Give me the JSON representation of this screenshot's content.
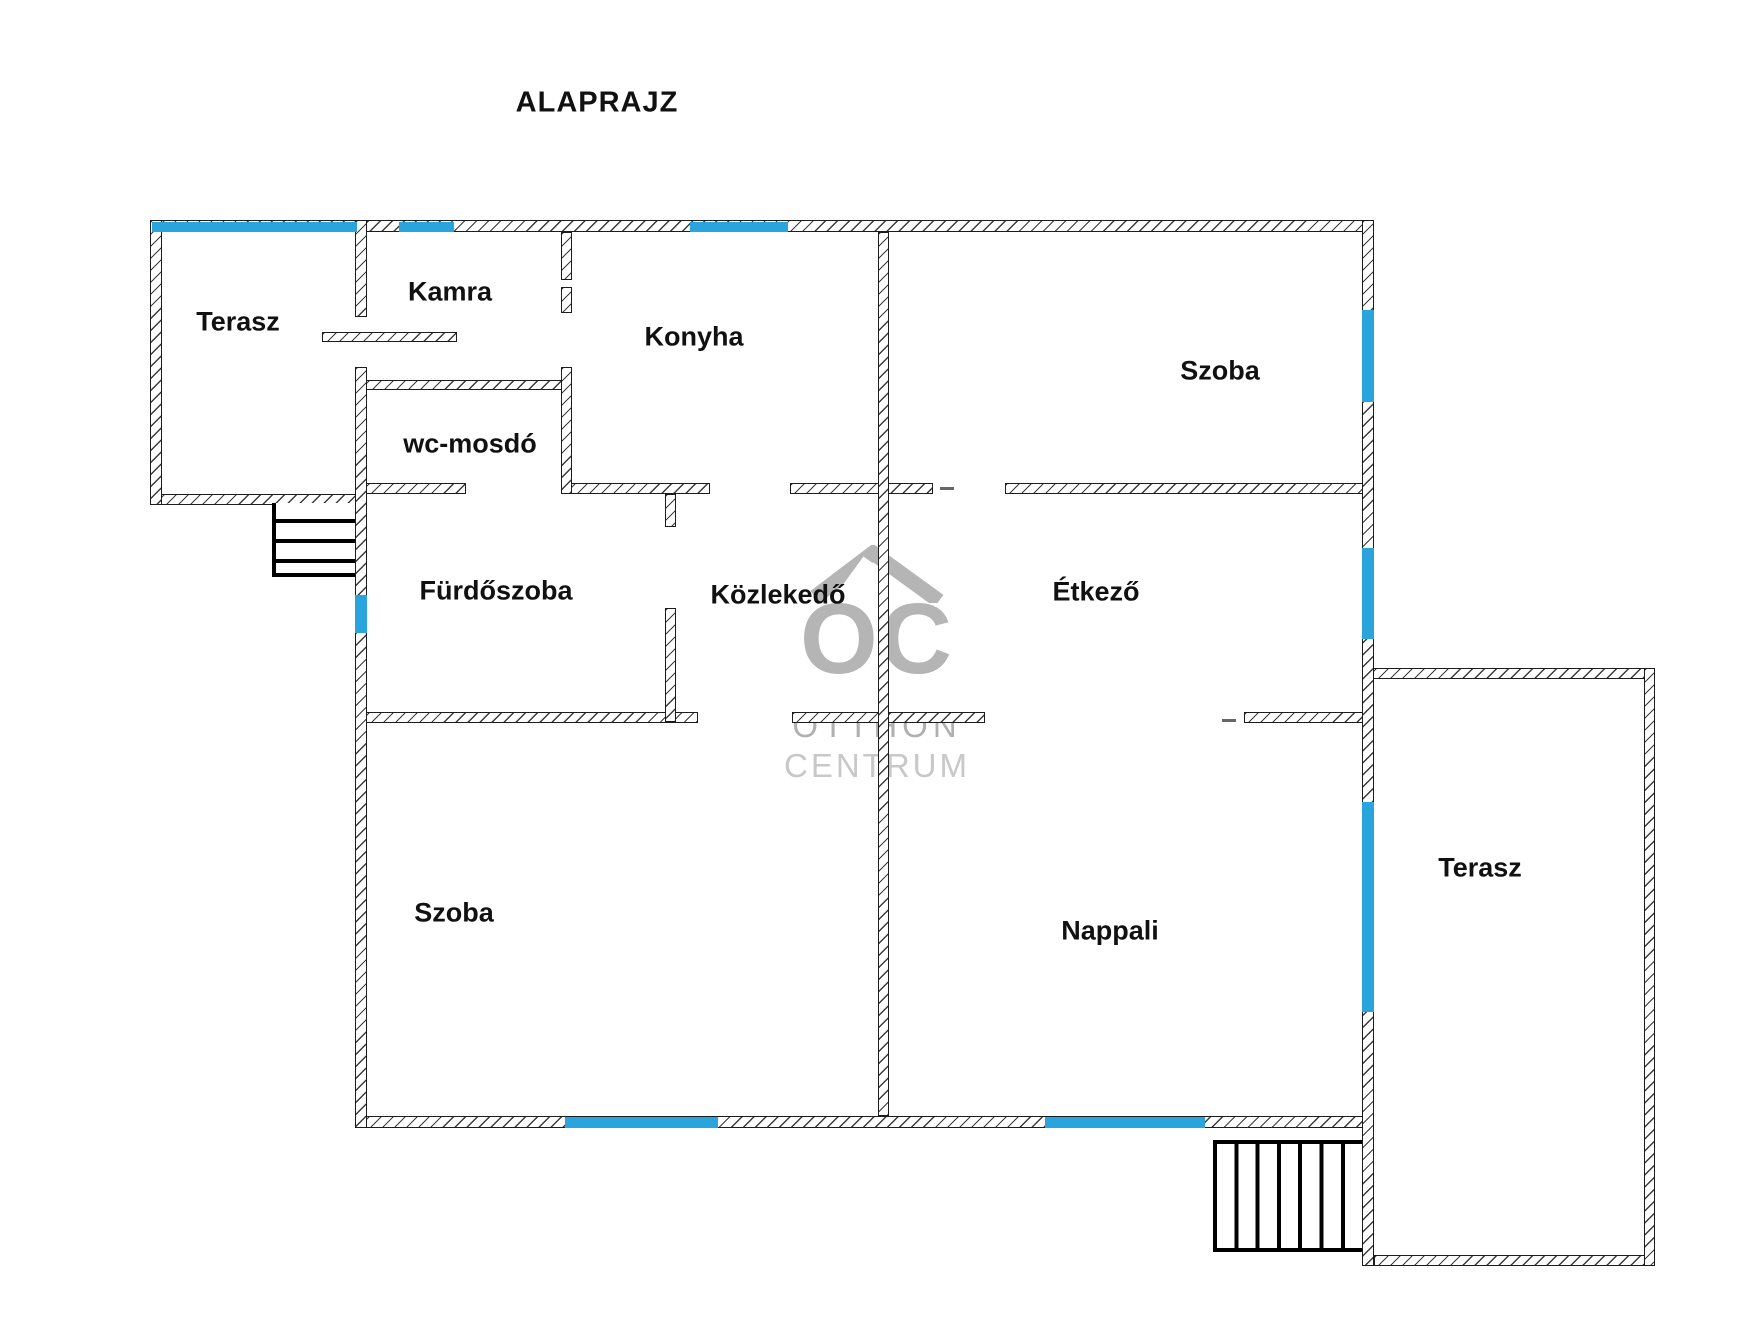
{
  "title": "ALAPRAJZ",
  "rooms": [
    {
      "id": "terasz-top-left",
      "label": "Terasz"
    },
    {
      "id": "kamra",
      "label": "Kamra"
    },
    {
      "id": "konyha",
      "label": "Konyha"
    },
    {
      "id": "szoba-top-right",
      "label": "Szoba"
    },
    {
      "id": "wc-mosdo",
      "label": "wc-mosdó"
    },
    {
      "id": "furdoszoba",
      "label": "Fürdőszoba"
    },
    {
      "id": "kozlekedo",
      "label": "Közlekedő"
    },
    {
      "id": "etkezo",
      "label": "Étkező"
    },
    {
      "id": "szoba-bottom-left",
      "label": "Szoba"
    },
    {
      "id": "nappali",
      "label": "Nappali"
    },
    {
      "id": "terasz-right",
      "label": "Terasz"
    }
  ],
  "watermark": {
    "logo": "OC",
    "line1": "OTTHON",
    "line2": "CENTRUM"
  },
  "colors": {
    "window_blue": "#29a4dd",
    "wall_line": "#1c1c1c",
    "watermark_gray": "#b5b5b5",
    "watermark_light_gray": "#c8c8c8"
  }
}
